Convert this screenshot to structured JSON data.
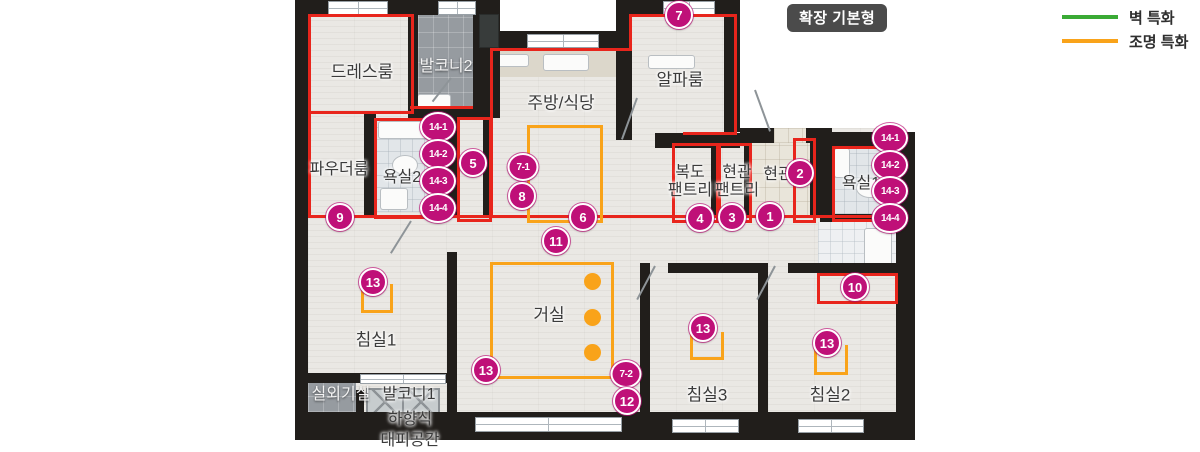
{
  "title_badge": {
    "label": "확장 기본형"
  },
  "legend": {
    "items": [
      {
        "label": "벽 특화",
        "color": "#3aaa35"
      },
      {
        "label": "조명 특화",
        "color": "#f9a31a"
      }
    ]
  },
  "plan": {
    "colors": {
      "wall": "#211e1b",
      "red_outline": "#e8251c",
      "orange_zone": "#f9a31a",
      "marker": "#bf1078",
      "floor": "#eae8e4"
    },
    "room_labels": [
      {
        "label": "드레스룸",
        "x": 362,
        "y": 72
      },
      {
        "label": "발코니2",
        "x": 446,
        "y": 67,
        "cls": "light",
        "size": 16
      },
      {
        "label": "주방/식당",
        "x": 561,
        "y": 103
      },
      {
        "label": "알파룸",
        "x": 680,
        "y": 80
      },
      {
        "label": "파우더룸",
        "x": 339,
        "y": 170,
        "size": 16
      },
      {
        "label": "욕실2",
        "x": 402,
        "y": 178,
        "size": 16
      },
      {
        "label": "복도\n팬트리",
        "x": 690,
        "y": 182,
        "size": 16
      },
      {
        "label": "현관\n팬트리",
        "x": 737,
        "y": 182,
        "size": 16
      },
      {
        "label": "현관",
        "x": 778,
        "y": 175,
        "size": 16
      },
      {
        "label": "욕실1",
        "x": 861,
        "y": 184,
        "size": 16
      },
      {
        "label": "침실1",
        "x": 376,
        "y": 340
      },
      {
        "label": "거실",
        "x": 549,
        "y": 315
      },
      {
        "label": "침실3",
        "x": 707,
        "y": 395
      },
      {
        "label": "침실2",
        "x": 830,
        "y": 395
      },
      {
        "label": "실외기실",
        "x": 341,
        "y": 395,
        "cls": "light",
        "size": 16
      },
      {
        "label": "발코니1",
        "x": 409,
        "y": 395,
        "size": 16
      },
      {
        "label": "하향식",
        "x": 410,
        "y": 420,
        "size": 16
      },
      {
        "label": "대피공간",
        "x": 410,
        "y": 441,
        "size": 16
      }
    ],
    "markers": [
      {
        "label": "7",
        "x": 679,
        "y": 15
      },
      {
        "label": "9",
        "x": 340,
        "y": 217
      },
      {
        "label": "14-1",
        "x": 438,
        "y": 127,
        "kind": "oval"
      },
      {
        "label": "14-2",
        "x": 438,
        "y": 154,
        "kind": "oval"
      },
      {
        "label": "14-3",
        "x": 438,
        "y": 181,
        "kind": "oval"
      },
      {
        "label": "14-4",
        "x": 438,
        "y": 208,
        "kind": "oval"
      },
      {
        "label": "5",
        "x": 473,
        "y": 163
      },
      {
        "label": "7-1",
        "x": 523,
        "y": 167,
        "kind": "oval-sm"
      },
      {
        "label": "8",
        "x": 522,
        "y": 196
      },
      {
        "label": "6",
        "x": 583,
        "y": 217
      },
      {
        "label": "11",
        "x": 556,
        "y": 241
      },
      {
        "label": "4",
        "x": 700,
        "y": 218
      },
      {
        "label": "3",
        "x": 732,
        "y": 217
      },
      {
        "label": "1",
        "x": 770,
        "y": 216
      },
      {
        "label": "2",
        "x": 800,
        "y": 173
      },
      {
        "label": "14-1",
        "x": 890,
        "y": 138,
        "kind": "oval"
      },
      {
        "label": "14-2",
        "x": 890,
        "y": 165,
        "kind": "oval"
      },
      {
        "label": "14-3",
        "x": 890,
        "y": 191,
        "kind": "oval"
      },
      {
        "label": "14-4",
        "x": 890,
        "y": 218,
        "kind": "oval"
      },
      {
        "label": "13",
        "x": 373,
        "y": 282
      },
      {
        "label": "13",
        "x": 486,
        "y": 370
      },
      {
        "label": "10",
        "x": 855,
        "y": 287
      },
      {
        "label": "13",
        "x": 703,
        "y": 328
      },
      {
        "label": "13",
        "x": 827,
        "y": 343
      },
      {
        "label": "7-2",
        "x": 626,
        "y": 374,
        "kind": "oval-sm"
      },
      {
        "label": "12",
        "x": 627,
        "y": 401
      }
    ]
  }
}
